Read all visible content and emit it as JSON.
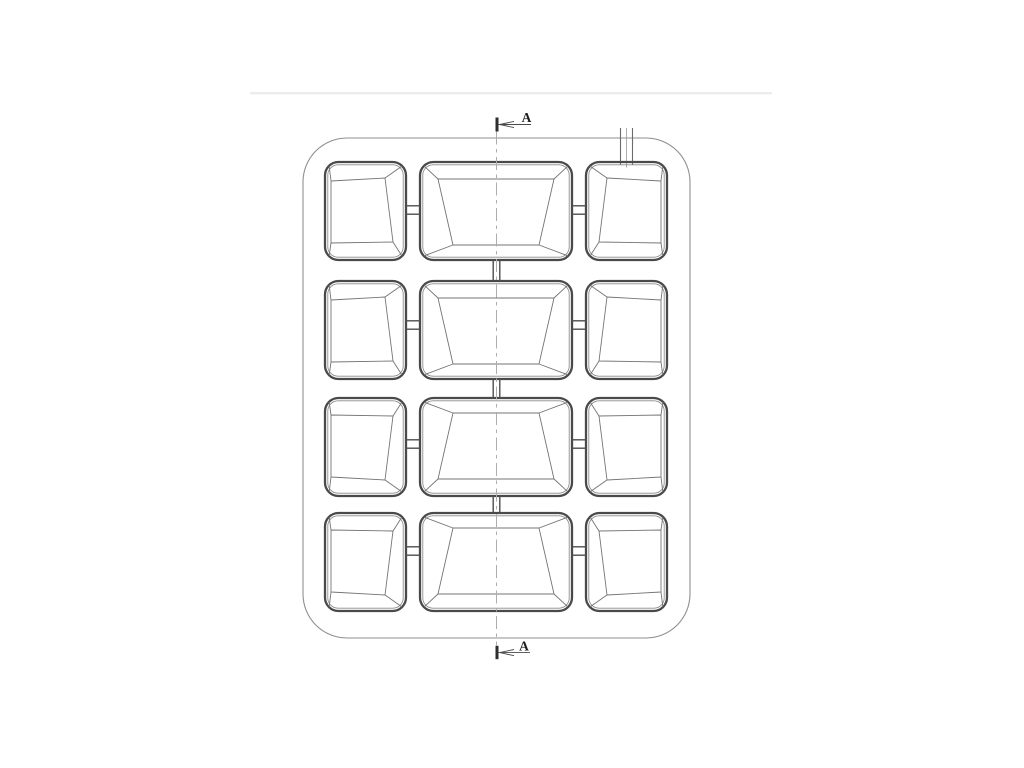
{
  "page": {
    "background_color": "#ffffff",
    "separator_color": "#ececec"
  },
  "drawing": {
    "type": "technical_drawing",
    "section_label": "A",
    "grid": {
      "rows": 4,
      "columns": 3,
      "cavity_count": 12
    },
    "colors": {
      "pocket_outline": "#4a4a4a",
      "pocket_rim": "#8a8a8a",
      "detail_line": "#747474",
      "tray_outline": "#8f8f8f",
      "runner_line": "#4f4f4f",
      "center_line": "#adadad",
      "sprue_line": "#6b6b6b",
      "marker_tick": "#2e2e2e",
      "marker_line": "#4a4a4a",
      "label_text": "#1c1c1c"
    }
  }
}
